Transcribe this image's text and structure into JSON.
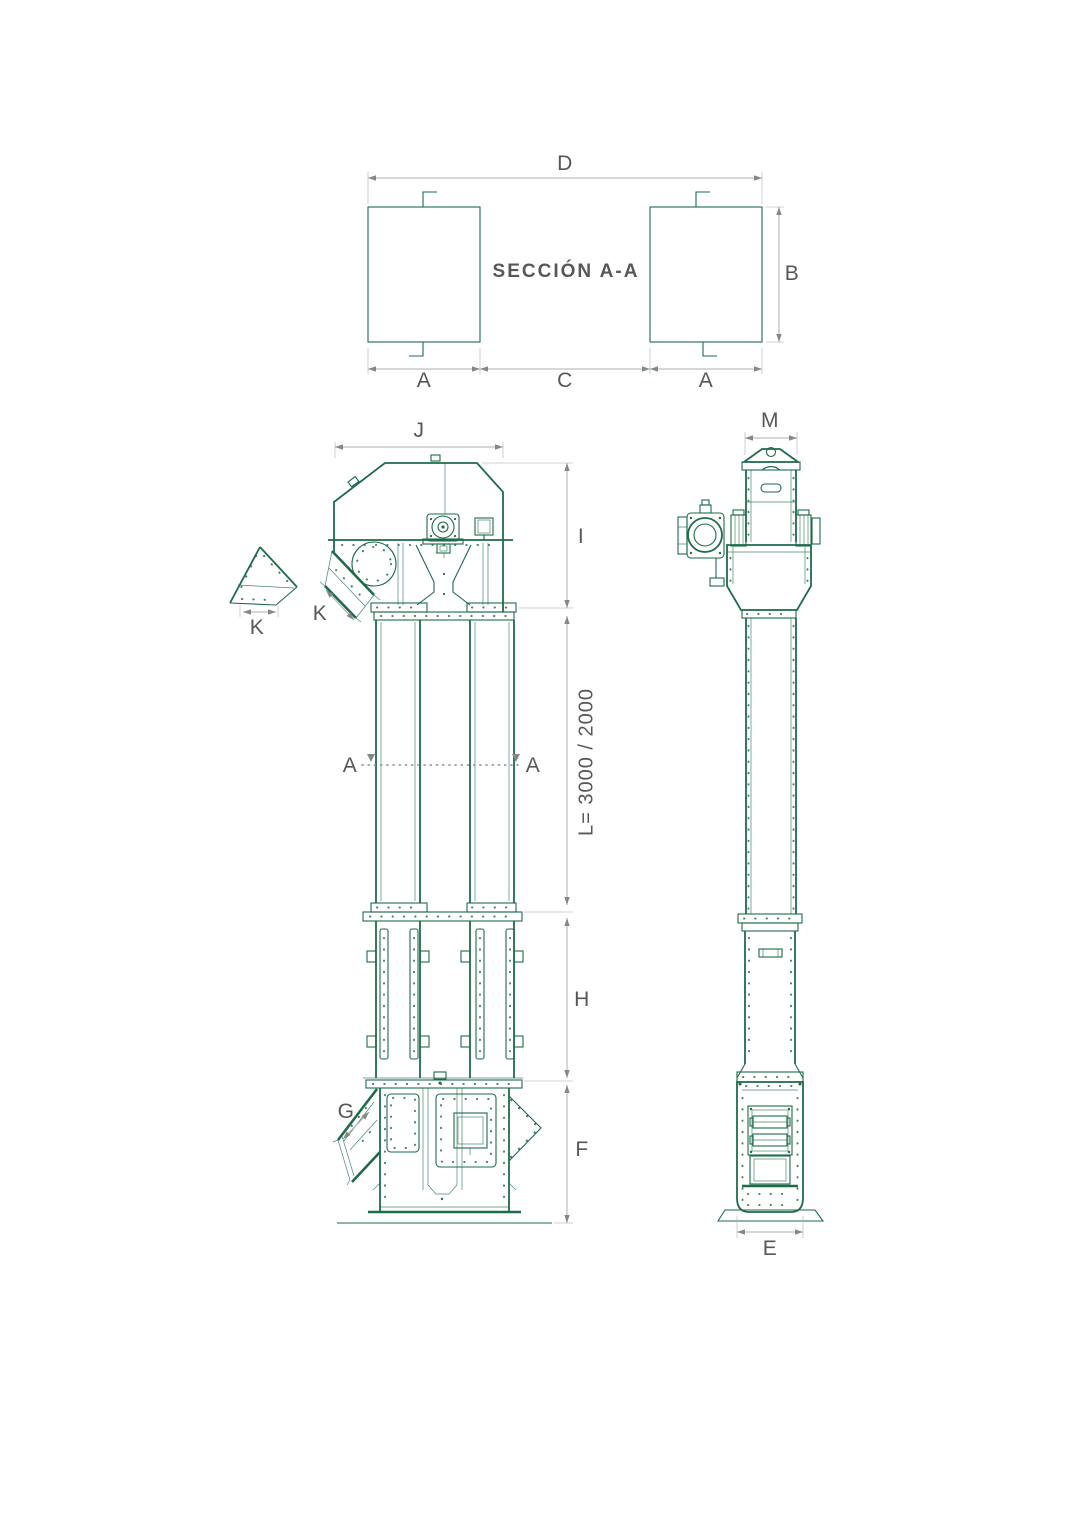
{
  "drawing": {
    "title": "SECCIÓN A-A",
    "section_view": {
      "dim_width_total": "D",
      "dim_height": "B",
      "dim_leg_left": "A",
      "dim_center": "C",
      "dim_leg_right": "A"
    },
    "front_view": {
      "dim_head_width": "J",
      "dim_head_height": "I",
      "dim_discharge_spout": "K",
      "dim_spout_detail": "K",
      "cut_label_left": "A",
      "cut_label_right": "A",
      "dim_trunking_length": "L= 3000 / 2000",
      "dim_guide_section": "H",
      "dim_inlet_spout": "G",
      "dim_boot_height": "F"
    },
    "side_view": {
      "dim_head_depth": "M",
      "dim_base_depth": "E"
    },
    "colors": {
      "drawing_line": "#1e6b4a",
      "dimension_line": "#a9b0ad",
      "label_text": "#55575a"
    }
  }
}
